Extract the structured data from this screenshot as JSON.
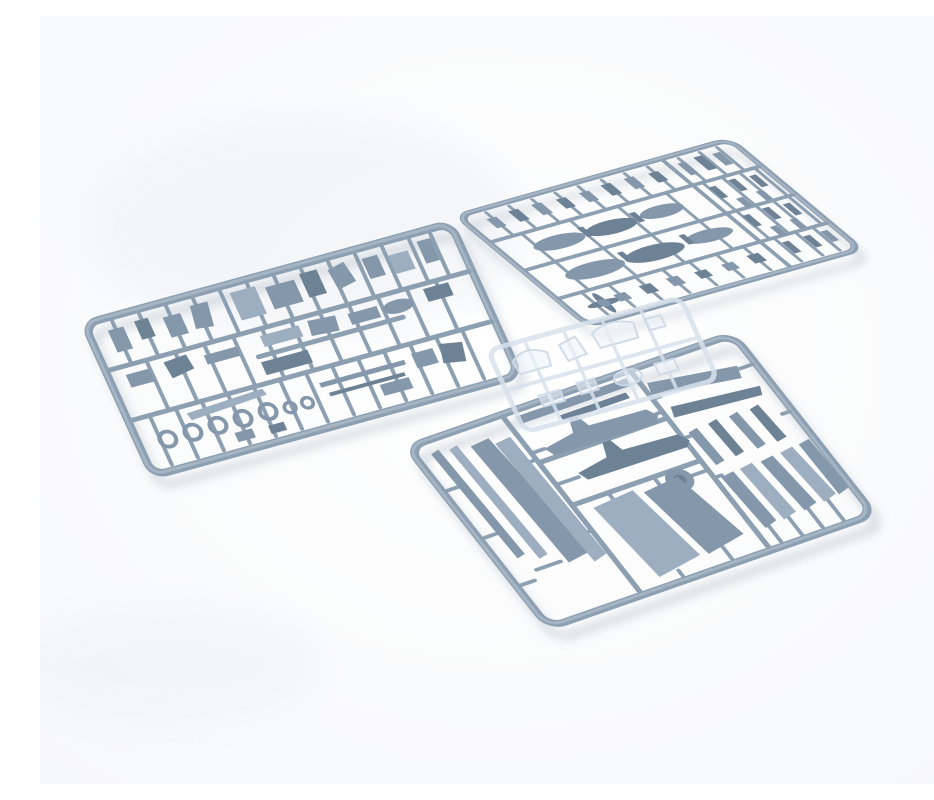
{
  "scene": {
    "title": "Plastic model kit sprues",
    "description": "Product photograph of three grey-blue injection-molded plastic sprues of an aircraft model kit laid on a white background: a detail-parts sprue on the left, an ordnance sprue with drop tanks and small bombs at the top right, a large airframe sprue with fuselage halves, wings and blades at the bottom, and a faint transparent clear-parts sprue in the middle.",
    "background_color": "#fdfdfe"
  },
  "palette": {
    "background": "#fdfdfe",
    "rail": "#8da0b2",
    "rail_hi": "#a6b5c4",
    "part": "#8497ab",
    "part_light": "#9caebf",
    "part_dark": "#6e8296",
    "clear": "#d8e2ed",
    "shadow": "rgba(150,162,178,0.32)"
  },
  "objects": {
    "sprue_left": {
      "label": "Detail parts sprue (cockpit pieces, bulkheads, wheels, rods)",
      "color": "#8da0b2",
      "parts_visible": [
        "small cockpit parts",
        "bulkheads",
        "seat",
        "wheel rings",
        "thin rods",
        "propeller blade"
      ]
    },
    "sprue_top_right": {
      "label": "Ordnance sprue (drop tank halves, small bombs, rockets, propeller)",
      "color": "#8da0b2",
      "parts_visible": [
        "drop tank halves",
        "small bombs",
        "rockets",
        "propeller",
        "small fittings"
      ]
    },
    "sprue_bottom": {
      "label": "Airframe sprue (fuselage halves, wing panels, blades, doors, flaps)",
      "color": "#8da0b2",
      "parts_visible": [
        "fuselage halves",
        "wing panels",
        "propeller blades",
        "landing gear doors",
        "flap fairings",
        "wheel disc"
      ]
    },
    "sprue_clear": {
      "label": "Clear sprue (canopy and windscreen parts)",
      "color": "#d8e2ed",
      "parts_visible": [
        "canopy bubble",
        "windscreen",
        "small clear panes"
      ]
    }
  }
}
